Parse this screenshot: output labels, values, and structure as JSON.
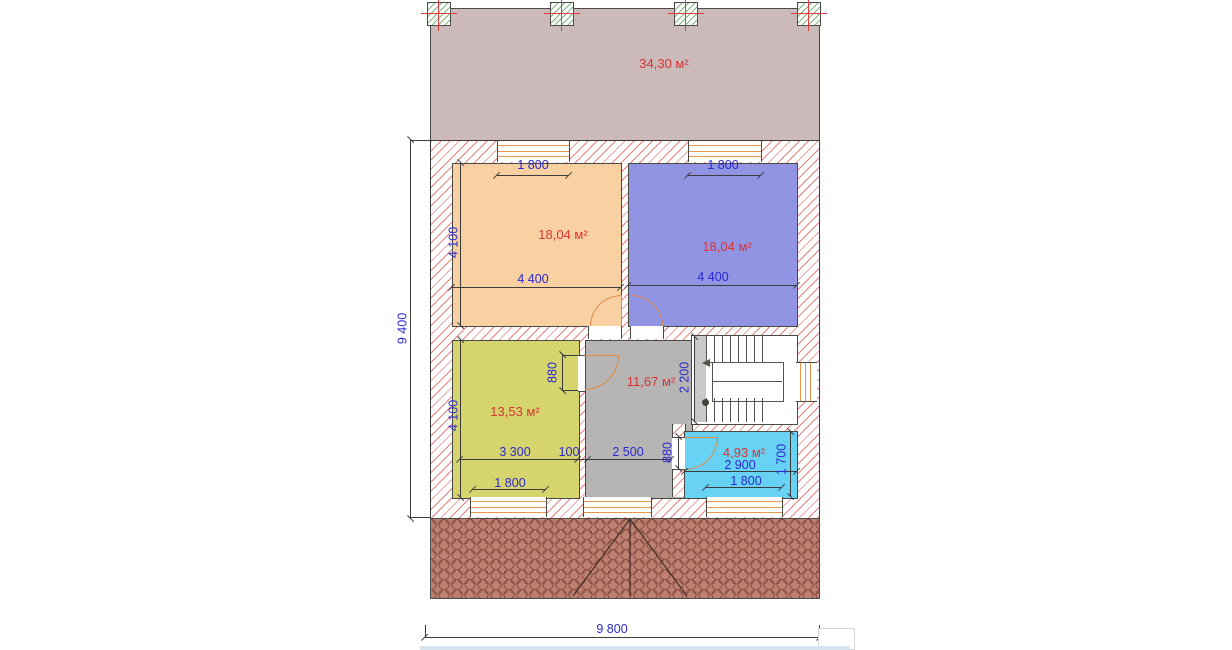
{
  "plan": {
    "areas": {
      "terrace": "34,30 м²",
      "bedroom_left": "18,04 м²",
      "bedroom_right": "18,04 м²",
      "room_bottom_left": "13,53 м²",
      "hall": "11,67 м²",
      "bathroom": "4,93 м²"
    },
    "dimensions": {
      "overall_height": "9 400",
      "overall_width": "9 800",
      "window_top_left": "1 800",
      "window_top_right": "1 800",
      "bedroom_left_height": "4 100",
      "bedroom_left_width": "4 400",
      "bedroom_right_width": "4 400",
      "room_bottom_left_height": "4 100",
      "room_bottom_left_width": "3 300",
      "wall_thickness": "100",
      "hall_width": "2 500",
      "hall_door_width": "880",
      "bathroom_door_width": "880",
      "stair_depth": "2 200",
      "window_bottom_left": "1 800",
      "bathroom_width": "2 900",
      "bathroom_height": "1 700",
      "window_bathroom": "1 800"
    },
    "colors": {
      "terrace_fill": "#ccb9b9",
      "bedroom_left_fill": "#f8d0a2",
      "bedroom_right_fill": "#9193e3",
      "room_bl_fill": "#d5d46d",
      "hall_fill": "#b7b5b3",
      "bathroom_fill": "#67d2f4",
      "wall_hatch": "#e88080",
      "dimension_text": "#2a2ad0",
      "area_text": "#d83434",
      "window_frame": "#e8964a",
      "door_arc": "#e08a45",
      "brick_fill": "#bd8172",
      "brick_line": "#8f5147"
    }
  }
}
